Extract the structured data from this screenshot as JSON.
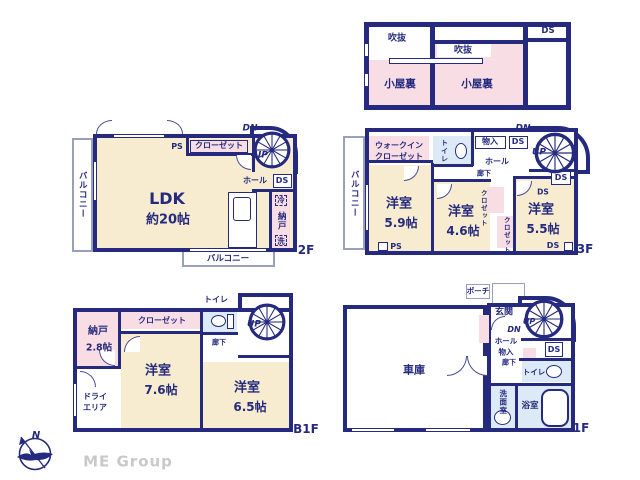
{
  "colors": {
    "wall": "#252a7e",
    "room_cream": "#f7ecd0",
    "room_pink": "#f8dde4",
    "water_blue": "#dce9f6",
    "balcony_line": "#98a0bd",
    "brand_gray": "#c9c9c9"
  },
  "attic": {
    "void_left": "吹抜",
    "void_mid": "吹抜",
    "loft_left": "小屋裏",
    "loft_mid": "小屋裏",
    "ds": "DS"
  },
  "f2": {
    "floor_label": "2F",
    "balcony_left": "バルコニー",
    "balcony_bottom": "バルコニー",
    "ps": "PS",
    "closet": "クローゼット",
    "dn": "DN",
    "up": "UP",
    "hall": "ホール",
    "ds": "DS",
    "ldk_name": "LDK",
    "ldk_size": "約20帖",
    "fridge": "冷",
    "pantry": "納戸",
    "laundry": "洗"
  },
  "f3": {
    "floor_label": "3F",
    "balcony": "バルコニー",
    "wic_line1": "ウォークイン",
    "wic_line2": "クローゼット",
    "toilet": "トイレ",
    "mono": "物入",
    "ds_top": "DS",
    "ds_stair": "DS",
    "ds_room": "DS",
    "ds_bottom": "DS",
    "dn": "DN",
    "up": "UP",
    "hall": "ホール",
    "corridor": "廊下",
    "room1_name": "洋室",
    "room1_size": "5.9帖",
    "room2_name": "洋室",
    "room2_size": "4.6帖",
    "room3_name": "洋室",
    "room3_size": "5.5帖",
    "closet_a": "クロゼット",
    "closet_b": "クロゼット",
    "ps": "PS"
  },
  "b1": {
    "floor_label": "B1F",
    "nando_name": "納戸",
    "nando_size": "2.8帖",
    "closet": "クローゼット",
    "toilet": "トイレ",
    "up": "UP",
    "corridor": "廊下",
    "room1_name": "洋室",
    "room1_size": "7.6帖",
    "room2_name": "洋室",
    "room2_size": "6.5帖",
    "dry_line1": "ドライ",
    "dry_line2": "エリア"
  },
  "f1": {
    "floor_label": "1F",
    "garage": "車庫",
    "porch": "ポーチ",
    "entrance": "玄関",
    "dn": "DN",
    "up": "UP",
    "hall": "ホール",
    "mono": "物入",
    "corridor": "廊下",
    "ds": "DS",
    "toilet": "トイレ",
    "washroom": "洗面室",
    "bath": "浴室"
  },
  "footer": {
    "compass_n": "N",
    "brand": "ME Group"
  }
}
